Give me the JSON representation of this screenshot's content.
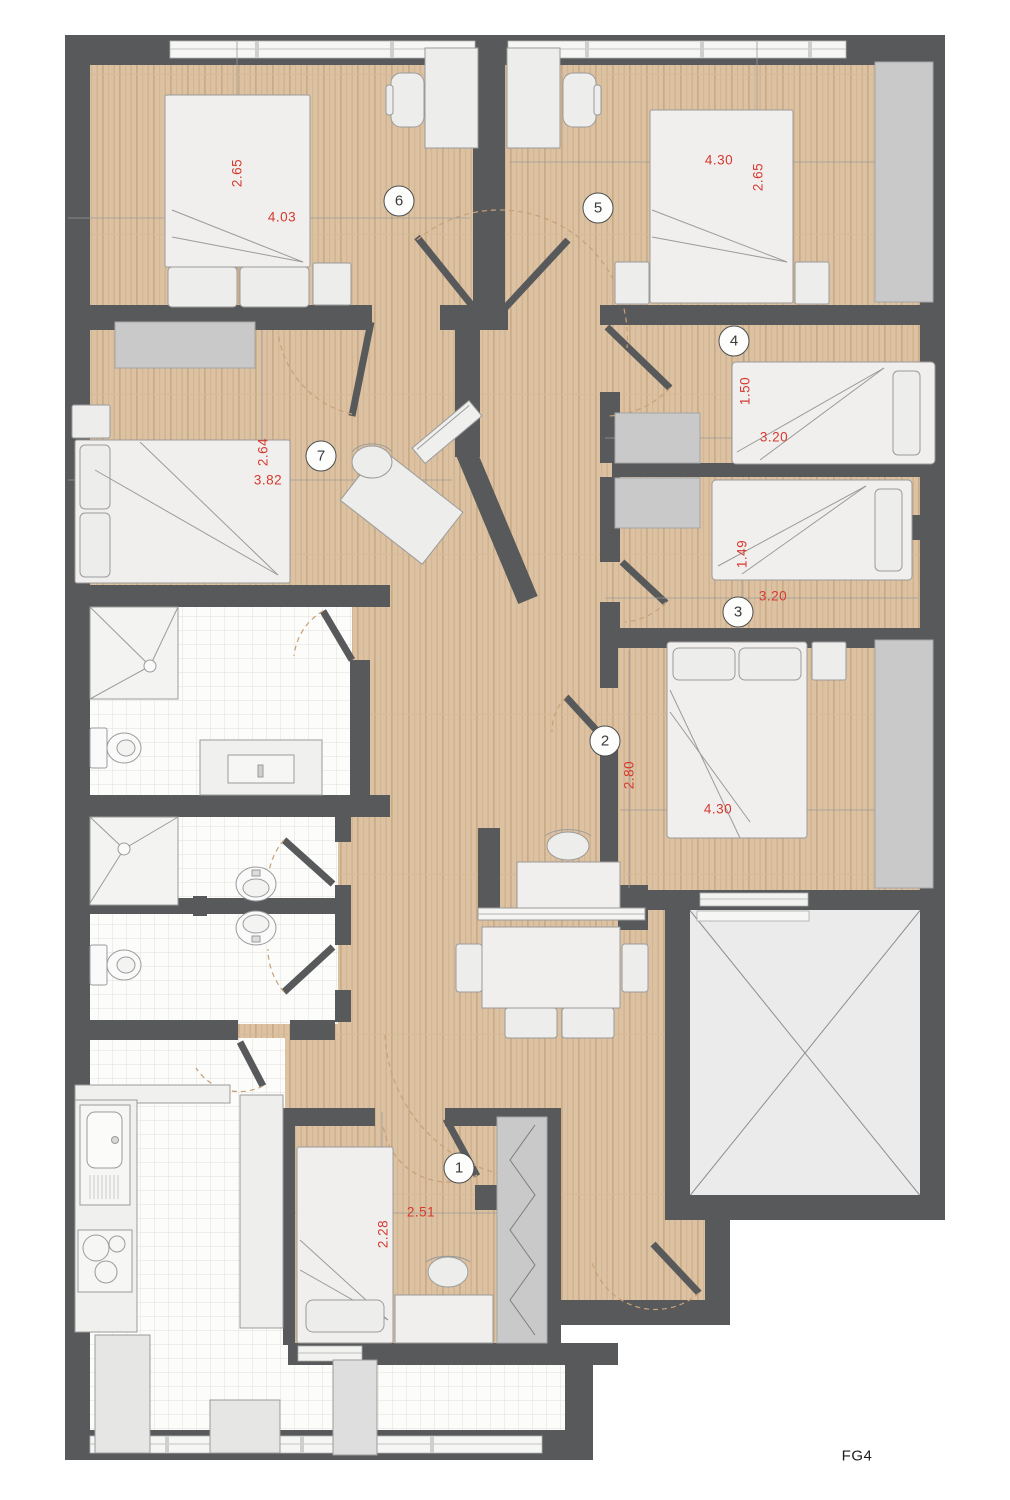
{
  "plan": {
    "label": "FG4",
    "colors": {
      "wall": "#58595b",
      "wood": "#dcc2a2",
      "wood_grain": "#c9ab85",
      "tile_line": "#e2dfda",
      "furniture": "#ededec",
      "furniture_stroke": "#9b9b9b",
      "wardrobe": "#c9c9ca",
      "dimension_text": "#d6392e",
      "door_arc": "#c8a078",
      "void_fill": "#ebebeb"
    }
  },
  "rooms": [
    {
      "number": "1"
    },
    {
      "number": "2"
    },
    {
      "number": "3"
    },
    {
      "number": "4"
    },
    {
      "number": "5"
    },
    {
      "number": "6"
    },
    {
      "number": "7"
    }
  ],
  "dimensions": [
    {
      "value": "2.65",
      "room": "6"
    },
    {
      "value": "4.03",
      "room": "6"
    },
    {
      "value": "4.30",
      "room": "5"
    },
    {
      "value": "2.65",
      "room": "5"
    },
    {
      "value": "1.50",
      "room": "4"
    },
    {
      "value": "3.20",
      "room": "4"
    },
    {
      "value": "1.49",
      "room": "3"
    },
    {
      "value": "3.20",
      "room": "3"
    },
    {
      "value": "2.64",
      "room": "7"
    },
    {
      "value": "3.82",
      "room": "7"
    },
    {
      "value": "2.80",
      "room": "2"
    },
    {
      "value": "4.30",
      "room": "2"
    },
    {
      "value": "2.51",
      "room": "1"
    },
    {
      "value": "2.28",
      "room": "1"
    }
  ]
}
